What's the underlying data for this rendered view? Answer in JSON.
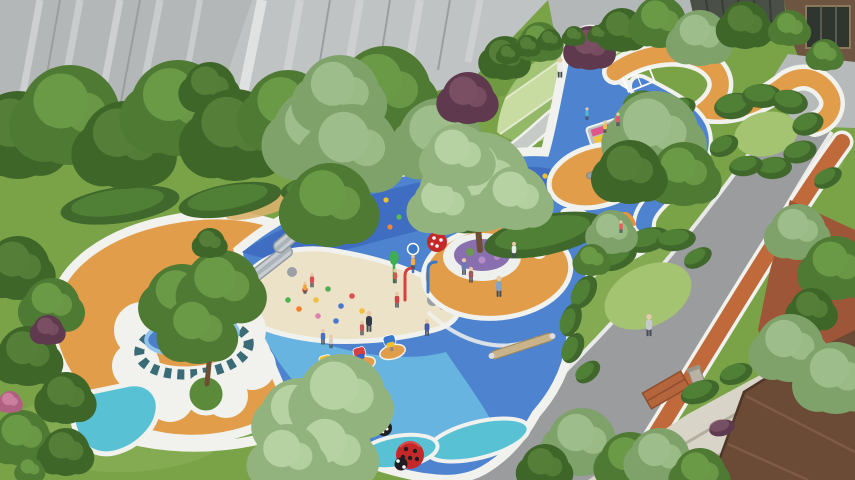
{
  "scene": {
    "title": "Aerial architectural rendering of a residential children's playground",
    "setting": "courtyard playground between a gray high-rise and a brown low-rise building",
    "features": [
      "organic blue rubber play surface",
      "sand pit with slides and climbing mound",
      "central tree with round bench and orange ring",
      "sawtooth mosaic ring pool",
      "terraced lawn steps",
      "winding orange and blue paths with hedge mounds",
      "splash pad with orange arches",
      "spring riders",
      "ladybug sculptures",
      "curved gray road with orange jogging track"
    ]
  },
  "palette": {
    "lawn": "#7aa348",
    "lawn_light": "#8db45a",
    "lawn_dark": "#5f8a38",
    "lawn_pale": "#a5c472",
    "blue_main": "#4e83cf",
    "blue_deep": "#3e6dc2",
    "blue_light": "#6cb9e2",
    "blue_pool": "#4a7fd0",
    "blue_pool_light": "#8fc3e8",
    "teal_pad": "#58c2d4",
    "teal_deep": "#2e8f9e",
    "orange_ground": "#e29d4a",
    "orange_track": "#c06a3c",
    "tan_streak": "#d9b06a",
    "arch_orange": "#e8923c",
    "sand": "#ece2c8",
    "white": "#f1f2ee",
    "road": "#9a9c9e",
    "curb": "#e8e9e8",
    "plaza": "#b7babb",
    "bldg_a": "#b4b7b8",
    "bldg_b": "#c0c3c4",
    "streak_light": "#d8dadb",
    "streak_dark": "#9b9ea0",
    "pillar_white": "#e4e6e6",
    "fence": "#4a4f48",
    "fence_slat": "#383d38",
    "brown_wall": "#6e5542",
    "glass": "#2f352f",
    "roof": "#6b4a36",
    "roof_light": "#84604a",
    "roof_edge": "#4e3628",
    "terracotta": "#9e5638",
    "pave": "#d9d4c8",
    "pave_line": "#b5ae9e",
    "sawtooth": "#3a6b77",
    "flower": "#8a6fae",
    "bench": "#eef0ee",
    "slide": "#c8cdd2",
    "slide_edge": "#8f989e",
    "wood": "#c9b38a",
    "trunk": "#6d4f33",
    "grass_circle": "#5a8a3a",
    "ladybug": "#c42828",
    "bug_black": "#1f1f22",
    "stone_path": "#c7cbc7",
    "terrace_edge": "#e2eace",
    "basin": "#8a9499",
    "rock": "#9aa0a4",
    "skin": "#e8c9a8",
    "legs": "#474e58",
    "pole_green": "#3fae4e",
    "pole_blue": "#3a78c8",
    "pole_red": "#d84040",
    "terraces": [
      "#bdd492",
      "#a2c374",
      "#c8dba0",
      "#93b868",
      "#aec983"
    ],
    "rainbow": [
      "#e0558a",
      "#f0c23e",
      "#4fc8d8",
      "#ef8a3c",
      "#8ed45c"
    ]
  },
  "tones": {
    "dark": [
      "#3f6629",
      "#557f38"
    ],
    "mid": [
      "#4f7a33",
      "#6b9a47"
    ],
    "sage": [
      "#7fa26b",
      "#9dbd8a"
    ],
    "lightsage": [
      "#93b37e",
      "#b6d1a2"
    ],
    "purple": [
      "#5f3a4e",
      "#7a4f63"
    ],
    "pink": [
      "#b06080",
      "#cc7f9d"
    ]
  },
  "trees": [
    {
      "x": 18,
      "y": 135,
      "r": 44,
      "tone": "dark"
    },
    {
      "x": 70,
      "y": 115,
      "r": 50,
      "tone": "mid"
    },
    {
      "x": 125,
      "y": 145,
      "r": 44,
      "tone": "dark"
    },
    {
      "x": 178,
      "y": 108,
      "r": 48,
      "tone": "mid"
    },
    {
      "x": 210,
      "y": 88,
      "r": 26,
      "tone": "dark"
    },
    {
      "x": 235,
      "y": 135,
      "r": 46,
      "tone": "dark"
    },
    {
      "x": 288,
      "y": 112,
      "r": 42,
      "tone": "mid"
    },
    {
      "x": 320,
      "y": 135,
      "r": 48,
      "tone": "sage"
    },
    {
      "x": 385,
      "y": 92,
      "r": 46,
      "tone": "mid"
    },
    {
      "x": 440,
      "y": 140,
      "r": 42,
      "tone": "sage"
    },
    {
      "x": 468,
      "y": 98,
      "r": 26,
      "tone": "purple"
    },
    {
      "x": 505,
      "y": 58,
      "r": 22,
      "tone": "dark"
    },
    {
      "x": 540,
      "y": 42,
      "r": 20,
      "tone": "mid"
    },
    {
      "x": 590,
      "y": 48,
      "r": 22,
      "tone": "purple"
    },
    {
      "x": 622,
      "y": 30,
      "r": 22,
      "tone": "dark"
    },
    {
      "x": 660,
      "y": 22,
      "r": 26,
      "tone": "mid"
    },
    {
      "x": 700,
      "y": 38,
      "r": 28,
      "tone": "sage"
    },
    {
      "x": 745,
      "y": 25,
      "r": 24,
      "tone": "dark"
    },
    {
      "x": 790,
      "y": 28,
      "r": 18,
      "tone": "mid"
    },
    {
      "x": 825,
      "y": 55,
      "r": 16,
      "tone": "mid"
    },
    {
      "x": 340,
      "y": 95,
      "r": 40,
      "tone": "sage"
    },
    {
      "x": 352,
      "y": 150,
      "r": 46,
      "tone": "sage"
    },
    {
      "x": 330,
      "y": 205,
      "r": 42,
      "tone": "mid"
    },
    {
      "x": 480,
      "y": 182,
      "r": 50,
      "tone": "lightsage"
    },
    {
      "x": 443,
      "y": 205,
      "r": 30,
      "tone": "lightsage"
    },
    {
      "x": 516,
      "y": 198,
      "r": 32,
      "tone": "lightsage"
    },
    {
      "x": 458,
      "y": 156,
      "r": 32,
      "tone": "lightsage"
    },
    {
      "x": 655,
      "y": 135,
      "r": 44,
      "tone": "sage"
    },
    {
      "x": 684,
      "y": 174,
      "r": 32,
      "tone": "mid"
    },
    {
      "x": 630,
      "y": 172,
      "r": 32,
      "tone": "dark"
    },
    {
      "x": 182,
      "y": 300,
      "r": 36,
      "tone": "mid"
    },
    {
      "x": 222,
      "y": 288,
      "r": 38,
      "tone": "mid"
    },
    {
      "x": 198,
      "y": 330,
      "r": 34,
      "tone": "mid"
    },
    {
      "x": 210,
      "y": 243,
      "r": 15,
      "tone": "dark"
    },
    {
      "x": 18,
      "y": 268,
      "r": 32,
      "tone": "dark"
    },
    {
      "x": 52,
      "y": 306,
      "r": 28,
      "tone": "mid"
    },
    {
      "x": 28,
      "y": 356,
      "r": 30,
      "tone": "dark"
    },
    {
      "x": 66,
      "y": 398,
      "r": 26,
      "tone": "dark"
    },
    {
      "x": 22,
      "y": 438,
      "r": 28,
      "tone": "mid"
    },
    {
      "x": 66,
      "y": 452,
      "r": 24,
      "tone": "dark"
    },
    {
      "x": 48,
      "y": 330,
      "r": 15,
      "tone": "purple"
    },
    {
      "x": 10,
      "y": 402,
      "r": 11,
      "tone": "pink"
    },
    {
      "x": 30,
      "y": 470,
      "r": 13,
      "tone": "mid"
    },
    {
      "x": 300,
      "y": 418,
      "r": 40,
      "tone": "lightsage"
    },
    {
      "x": 342,
      "y": 398,
      "r": 44,
      "tone": "lightsage"
    },
    {
      "x": 332,
      "y": 452,
      "r": 40,
      "tone": "lightsage"
    },
    {
      "x": 288,
      "y": 458,
      "r": 34,
      "tone": "lightsage"
    },
    {
      "x": 582,
      "y": 442,
      "r": 34,
      "tone": "sage"
    },
    {
      "x": 630,
      "y": 462,
      "r": 30,
      "tone": "mid"
    },
    {
      "x": 545,
      "y": 468,
      "r": 24,
      "tone": "dark"
    },
    {
      "x": 612,
      "y": 232,
      "r": 22,
      "tone": "sage"
    },
    {
      "x": 592,
      "y": 260,
      "r": 16,
      "tone": "mid"
    },
    {
      "x": 798,
      "y": 232,
      "r": 28,
      "tone": "sage"
    },
    {
      "x": 836,
      "y": 268,
      "r": 32,
      "tone": "mid"
    },
    {
      "x": 812,
      "y": 310,
      "r": 22,
      "tone": "dark"
    },
    {
      "x": 790,
      "y": 348,
      "r": 34,
      "tone": "sage"
    },
    {
      "x": 836,
      "y": 378,
      "r": 36,
      "tone": "sage"
    },
    {
      "x": 660,
      "y": 458,
      "r": 30,
      "tone": "sage"
    },
    {
      "x": 700,
      "y": 474,
      "r": 26,
      "tone": "mid"
    },
    {
      "x": 508,
      "y": 54,
      "r": 10,
      "tone": "dark"
    },
    {
      "x": 528,
      "y": 46,
      "r": 11,
      "tone": "dark"
    },
    {
      "x": 550,
      "y": 40,
      "r": 11,
      "tone": "dark"
    },
    {
      "x": 574,
      "y": 36,
      "r": 10,
      "tone": "dark"
    },
    {
      "x": 598,
      "y": 34,
      "r": 9,
      "tone": "dark"
    }
  ],
  "hedges": [
    {
      "x": 120,
      "y": 205,
      "rx": 60,
      "ry": 18,
      "rot": -8
    },
    {
      "x": 230,
      "y": 200,
      "rx": 52,
      "ry": 16,
      "rot": -10
    },
    {
      "x": 318,
      "y": 186,
      "rx": 38,
      "ry": 13,
      "rot": -12
    },
    {
      "x": 545,
      "y": 235,
      "rx": 62,
      "ry": 20,
      "rot": -12
    },
    {
      "x": 482,
      "y": 218,
      "rx": 34,
      "ry": 13,
      "rot": -15
    },
    {
      "x": 618,
      "y": 258,
      "rx": 20,
      "ry": 11,
      "rot": -25
    },
    {
      "x": 648,
      "y": 240,
      "rx": 22,
      "ry": 12,
      "rot": -15
    },
    {
      "x": 676,
      "y": 240,
      "rx": 20,
      "ry": 11,
      "rot": -8
    },
    {
      "x": 698,
      "y": 258,
      "rx": 15,
      "ry": 9,
      "rot": -30
    },
    {
      "x": 584,
      "y": 292,
      "rx": 18,
      "ry": 11,
      "rot": -60
    },
    {
      "x": 571,
      "y": 320,
      "rx": 17,
      "ry": 10,
      "rot": -72
    },
    {
      "x": 573,
      "y": 348,
      "rx": 16,
      "ry": 10,
      "rot": -65
    },
    {
      "x": 588,
      "y": 372,
      "rx": 14,
      "ry": 9,
      "rot": -40
    },
    {
      "x": 640,
      "y": 102,
      "rx": 17,
      "ry": 11,
      "rot": -15
    },
    {
      "x": 680,
      "y": 108,
      "rx": 16,
      "ry": 10,
      "rot": -15
    },
    {
      "x": 734,
      "y": 106,
      "rx": 20,
      "ry": 13,
      "rot": -10
    },
    {
      "x": 762,
      "y": 96,
      "rx": 20,
      "ry": 12,
      "rot": 0
    },
    {
      "x": 790,
      "y": 102,
      "rx": 18,
      "ry": 12,
      "rot": 10
    },
    {
      "x": 808,
      "y": 124,
      "rx": 16,
      "ry": 11,
      "rot": -20
    },
    {
      "x": 800,
      "y": 152,
      "rx": 17,
      "ry": 11,
      "rot": -15
    },
    {
      "x": 774,
      "y": 168,
      "rx": 18,
      "ry": 11,
      "rot": -5
    },
    {
      "x": 746,
      "y": 166,
      "rx": 17,
      "ry": 10,
      "rot": -10
    },
    {
      "x": 724,
      "y": 146,
      "rx": 15,
      "ry": 10,
      "rot": -25
    },
    {
      "x": 700,
      "y": 392,
      "rx": 20,
      "ry": 11,
      "rot": -20
    },
    {
      "x": 736,
      "y": 374,
      "rx": 17,
      "ry": 10,
      "rot": -20
    },
    {
      "x": 722,
      "y": 428,
      "rx": 13,
      "ry": 8,
      "rot": -15,
      "c": "#5e3a50"
    },
    {
      "x": 828,
      "y": 178,
      "rx": 15,
      "ry": 9,
      "rot": -30
    }
  ],
  "people": [
    {
      "x": 312,
      "y": 284,
      "c": "#d94f4f",
      "s": 0.7
    },
    {
      "x": 305,
      "y": 291,
      "c": "#f0a23c",
      "s": 0.6
    },
    {
      "x": 323,
      "y": 341,
      "c": "#4a6fc0",
      "s": 0.75
    },
    {
      "x": 331,
      "y": 345,
      "c": "#d8cfc2",
      "s": 0.65
    },
    {
      "x": 369,
      "y": 327,
      "c": "#32394a",
      "s": 1.0
    },
    {
      "x": 362,
      "y": 332,
      "c": "#c05555",
      "s": 0.7
    },
    {
      "x": 397,
      "y": 304,
      "c": "#cc4444",
      "s": 0.75
    },
    {
      "x": 427,
      "y": 332,
      "c": "#4858a8",
      "s": 0.8
    },
    {
      "x": 395,
      "y": 280,
      "c": "#d05848",
      "s": 0.7
    },
    {
      "x": 413,
      "y": 266,
      "c": "#f0b048",
      "s": 0.7
    },
    {
      "x": 464,
      "y": 271,
      "c": "#6878b8",
      "s": 0.8
    },
    {
      "x": 471,
      "y": 279,
      "c": "#a05858",
      "s": 0.75
    },
    {
      "x": 499,
      "y": 292,
      "c": "#8aa2c4",
      "s": 1.0
    },
    {
      "x": 514,
      "y": 254,
      "c": "#e8eaec",
      "s": 0.75
    },
    {
      "x": 560,
      "y": 73,
      "c": "#ececee",
      "s": 0.95
    },
    {
      "x": 649,
      "y": 331,
      "c": "#c6cad0",
      "s": 1.05
    },
    {
      "x": 618,
      "y": 123,
      "c": "#e05878",
      "s": 0.65
    },
    {
      "x": 605,
      "y": 130,
      "c": "#eec050",
      "s": 0.6
    },
    {
      "x": 587,
      "y": 117,
      "c": "#50b0d0",
      "s": 0.6
    },
    {
      "x": 621,
      "y": 230,
      "c": "#e06060",
      "s": 0.6
    }
  ],
  "climb_dots": {
    "colors": [
      "#e04848",
      "#f0c030",
      "#58c050",
      "#f08830",
      "#ffffff"
    ],
    "points": [
      [
        302,
        212
      ],
      [
        316,
        200
      ],
      [
        330,
        218
      ],
      [
        344,
        204
      ],
      [
        359,
        194
      ],
      [
        372,
        212
      ],
      [
        386,
        200
      ],
      [
        399,
        217
      ],
      [
        412,
        205
      ],
      [
        426,
        195
      ],
      [
        438,
        211
      ],
      [
        452,
        201
      ],
      [
        330,
        231
      ],
      [
        390,
        227
      ],
      [
        302,
        196
      ],
      [
        420,
        224
      ],
      [
        545,
        176
      ],
      [
        553,
        186
      ]
    ]
  },
  "sand_toys": {
    "colors": [
      "#e05050",
      "#f0c040",
      "#50b050",
      "#4878d0",
      "#e080b0",
      "#f08030"
    ],
    "points": [
      [
        305,
        290
      ],
      [
        316,
        300
      ],
      [
        328,
        289
      ],
      [
        341,
        306
      ],
      [
        318,
        316
      ],
      [
        299,
        309
      ],
      [
        352,
        296
      ],
      [
        362,
        311
      ],
      [
        288,
        300
      ],
      [
        336,
        321
      ]
    ]
  },
  "riders": [
    {
      "x": 328,
      "y": 370,
      "c": [
        "#f0c030",
        "#d84040"
      ]
    },
    {
      "x": 362,
      "y": 362,
      "c": [
        "#d84040",
        "#3a60c0"
      ]
    },
    {
      "x": 392,
      "y": 350,
      "c": [
        "#3a78d0",
        "#f0c030"
      ]
    }
  ]
}
